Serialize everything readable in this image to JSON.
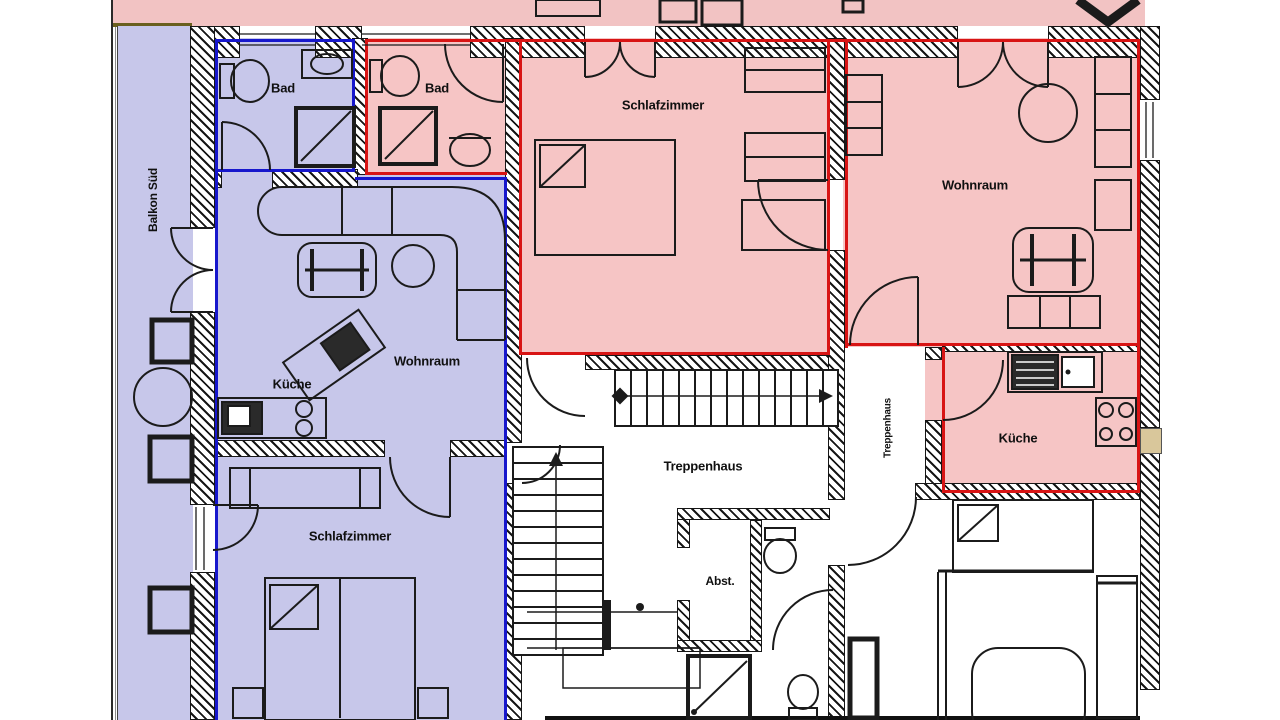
{
  "floor_plan": {
    "balcony": {
      "label": "Balkon Süd"
    },
    "apartment_blue": {
      "outline_color": "#1717cc",
      "fill_color": "#c7c7ea",
      "rooms": {
        "bathroom": "Bad",
        "living_room": "Wohnraum",
        "kitchen": "Küche",
        "bedroom": "Schlafzimmer"
      }
    },
    "apartment_red": {
      "outline_color": "#d81414",
      "fill_color": "#f6c5c5",
      "rooms": {
        "bathroom": "Bad",
        "bedroom": "Schlafzimmer",
        "living_room": "Wohnraum",
        "kitchen": "Küche"
      }
    },
    "shared": {
      "stairwell_main": "Treppenhaus",
      "stairwell_secondary": "Treppenhaus",
      "storage": "Abst."
    }
  }
}
